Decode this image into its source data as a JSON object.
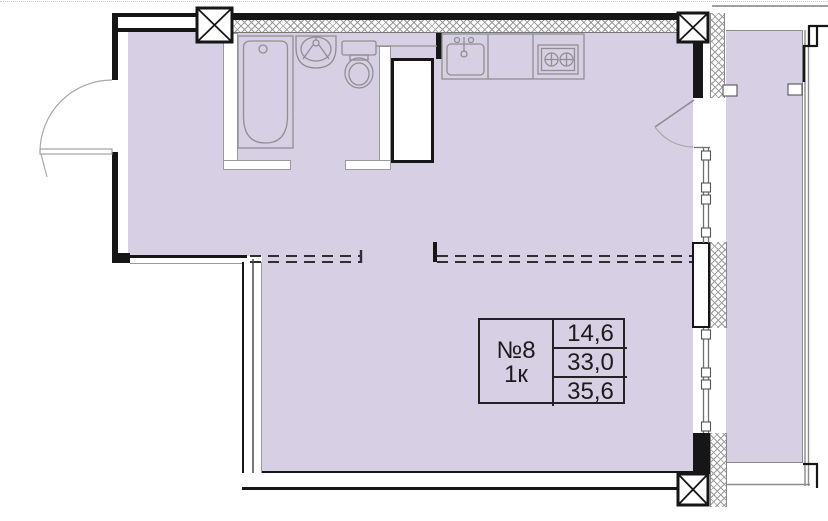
{
  "apartment": {
    "number": "№8",
    "room_count": "1к",
    "area_rows": [
      "14,6",
      "33,0",
      "35,6"
    ]
  },
  "colors": {
    "room_fill": "#d7cfe4",
    "wall": "#161616",
    "fixture_stroke": "#8f8f8f",
    "hatch": "#9b9b9b",
    "dashed": "#2f2f2f"
  },
  "fixtures": [
    "bathtub",
    "washbasin",
    "toilet",
    "ventilation-shaft",
    "kitchen-sink",
    "stove",
    "entry-door",
    "balcony-door",
    "windows",
    "balcony"
  ]
}
